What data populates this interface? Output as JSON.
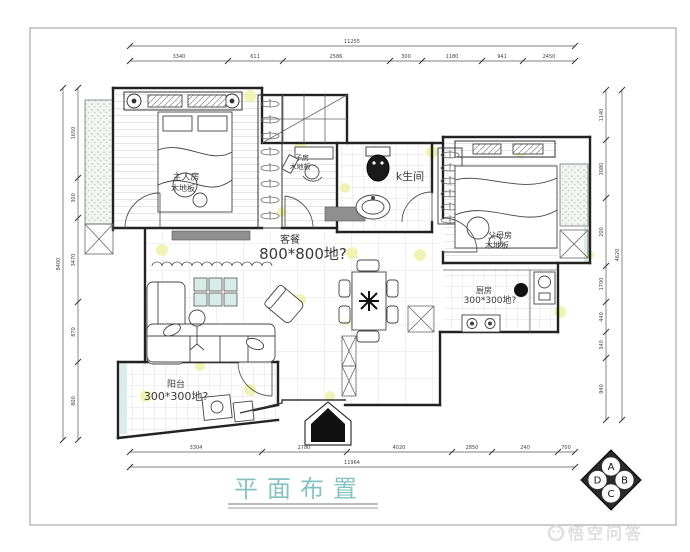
{
  "drawing": {
    "title": "平面布置",
    "watermark": "悟空问答"
  },
  "rooms": {
    "master": {
      "name": "主人房",
      "floor": "木地板"
    },
    "study": {
      "name": "子房",
      "floor": "木地板"
    },
    "bathroom": {
      "name": "k生间"
    },
    "parents": {
      "name": "父母房",
      "floor": "木地板"
    },
    "kitchen": {
      "name": "厨房",
      "floor": "300*300地?"
    },
    "living": {
      "name": "客餐",
      "floor": "800*800地?"
    },
    "balcony": {
      "name": "阳台",
      "floor": "300*300地?"
    }
  },
  "dimensions": {
    "top_overall": "11255",
    "top_segments": [
      "3340",
      "611",
      "2586",
      "300",
      "1180",
      "941",
      "2450"
    ],
    "bottom_segments": [
      "3304",
      "2780",
      "4020",
      "2850",
      "240",
      "700"
    ],
    "bottom_overall": "11964",
    "left_segments": [
      "1650",
      "300",
      "3470",
      "870",
      "800"
    ],
    "left_overall": "8400",
    "right_segments": [
      "1140",
      "3080",
      "200",
      "1700",
      "440",
      "340",
      "940"
    ],
    "right_overall": "4620"
  },
  "elevation_marker": {
    "top": "A",
    "right": "B",
    "bottom": "C",
    "left": "D"
  },
  "colors": {
    "title_teal": "#85c3c3",
    "accent_yellow": "#eef2a6",
    "stipple_teal": "#a8bfba",
    "watermark_gray": "#dedede"
  }
}
